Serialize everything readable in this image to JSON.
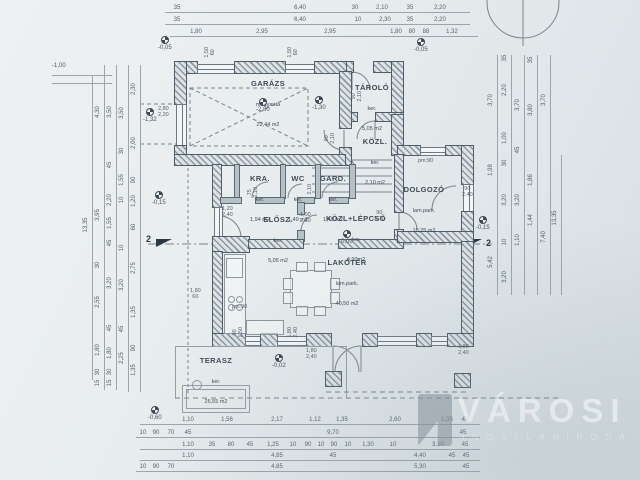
{
  "watermark": {
    "brand": "VÁROSI",
    "sub": "INGATLANIRODA"
  },
  "markers": {
    "section": "2",
    "pm": [
      "pm:90",
      "pm:90"
    ]
  },
  "rooms": [
    {
      "name": "GARÁZS",
      "finish": "műgyanta",
      "area": "22,44 m2"
    },
    {
      "name": "TÁROLÓ",
      "finish": "ker.",
      "area": "5,05 m2"
    },
    {
      "name": "KÖZL.",
      "finish": "ker.",
      "area": "2,10 m2"
    },
    {
      "name": "KRA.",
      "finish": "ker.",
      "area": "1,94 m2"
    },
    {
      "name": "WC",
      "finish": "ker.",
      "area": "1,40 m2"
    },
    {
      "name": "GARD.",
      "finish": "ker.",
      "area": "1,40 m2"
    },
    {
      "name": "ELŐSZ.",
      "finish": "ker.",
      "area": "5,05 m2"
    },
    {
      "name": "KÖZL+LÉPCSŐ",
      "finish": "ker.",
      "area": "4,90m2"
    },
    {
      "name": "DOLGOZÓ",
      "finish": "lam.park.",
      "area": "10,25 m2"
    },
    {
      "name": "LAKÓTÉR",
      "finish": "lam.park.",
      "area": "40,50 m2"
    },
    {
      "name": "TERASZ",
      "finish": "ker.",
      "area": "26,55 m2"
    }
  ],
  "elevations": [
    "-1,00",
    "-0,05",
    "-0,05",
    "-2,80",
    "-1,30",
    "-1,32",
    "-0,15",
    "0,00",
    "-0,15",
    "-0,02",
    "-0,60"
  ],
  "dims": {
    "t1": [
      "35",
      "6,40",
      "30",
      "2,10",
      "35",
      "2,20"
    ],
    "t2": [
      "35",
      "6,40",
      "10",
      "2,30",
      "35",
      "2,20"
    ],
    "t3": [
      "1,80",
      "2,95",
      "2,95",
      "1,80",
      "80",
      "88",
      "1,32"
    ],
    "b1": [
      "1,10",
      "1,56",
      "2,17",
      "1,12",
      "1,35",
      "2,60",
      "1,35",
      "45"
    ],
    "b2": [
      "10",
      "90",
      "70",
      "45",
      "9,70",
      "45"
    ],
    "b3": [
      "1,10",
      "35",
      "80",
      "45",
      "1,25",
      "10",
      "90",
      "10",
      "90",
      "10",
      "1,30",
      "10",
      "3,10",
      "45"
    ],
    "b4": [
      "1,10",
      "4,85",
      "45",
      "4,40",
      "45",
      "45"
    ],
    "b5": [
      "10",
      "90",
      "70",
      "4,85",
      "5,30",
      "45"
    ],
    "l0": [
      "13,35"
    ],
    "l1": [
      "4,30",
      "3,95",
      "30",
      "2,55",
      "1,80",
      "30",
      "15"
    ],
    "l2": [
      "3,50",
      "45",
      "2,20",
      "1,55",
      "45",
      "3,20",
      "45",
      "1,80",
      "30",
      "15"
    ],
    "l3": [
      "3,50",
      "30",
      "1,55",
      "10",
      "10",
      "3,20",
      "45",
      "2,25"
    ],
    "l4": [
      "2,30",
      "2,00",
      "90",
      "1,20",
      "60",
      "2,75",
      "1,35",
      "90",
      "1,35"
    ],
    "r0": [
      "3,70",
      "1,98",
      "5,42"
    ],
    "r1": [
      "35",
      "2,20",
      "1,00",
      "30",
      "3,20",
      "10",
      "3,20"
    ],
    "r2": [
      "3,70",
      "45",
      "3,20",
      "1,10"
    ],
    "r3": [
      "35",
      "3,80",
      "1,86",
      "1,44"
    ],
    "r4": [
      "3,70",
      "7,40"
    ],
    "r5": [
      "13,35"
    ]
  },
  "openings": [
    {
      "a": "1,50",
      "b": "60"
    },
    {
      "a": "1,50",
      "b": "60"
    },
    {
      "a": "90",
      "b": "2,10"
    },
    {
      "a": "90",
      "b": "2,10"
    },
    {
      "a": "75",
      "b": "2,10"
    },
    {
      "a": "2,10",
      "b": ""
    },
    {
      "a": "1,00",
      "b": "2,10"
    },
    {
      "a": "90",
      "b": "2,10"
    },
    {
      "a": "90",
      "b": "2,40"
    },
    {
      "a": "1,20",
      "b": "2,40"
    },
    {
      "a": "1,80",
      "b": "60"
    },
    {
      "a": "90",
      "b": "1,50"
    },
    {
      "a": "1,80",
      "b": "2,40"
    },
    {
      "a": "1,80",
      "b": "2,40"
    },
    {
      "a": "1,80",
      "b": "2,40"
    },
    {
      "a": "2,80",
      "b": "2,20"
    }
  ]
}
